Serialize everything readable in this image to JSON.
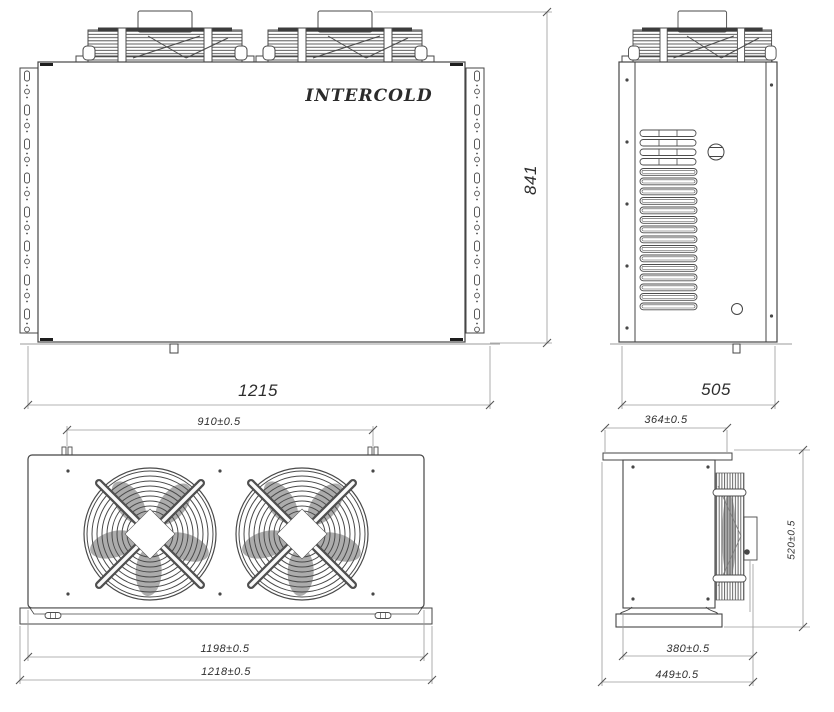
{
  "brand_label": "INTERCOLD",
  "views": {
    "front": {
      "width": "1215",
      "height": "841"
    },
    "side": {
      "depth": "505"
    },
    "plan": {
      "fan_pitch": "910±0.5",
      "body_width": "1198±0.5",
      "overall_width": "1218±0.5"
    },
    "side_section": {
      "top_depth": "364±0.5",
      "height": "520±0.5",
      "body_depth": "380±0.5",
      "overall_depth": "449±0.5"
    }
  },
  "colors": {
    "line": "#454545",
    "dim_line": "#9a9a9a",
    "text": "#2e2e2e",
    "background": "#ffffff"
  }
}
